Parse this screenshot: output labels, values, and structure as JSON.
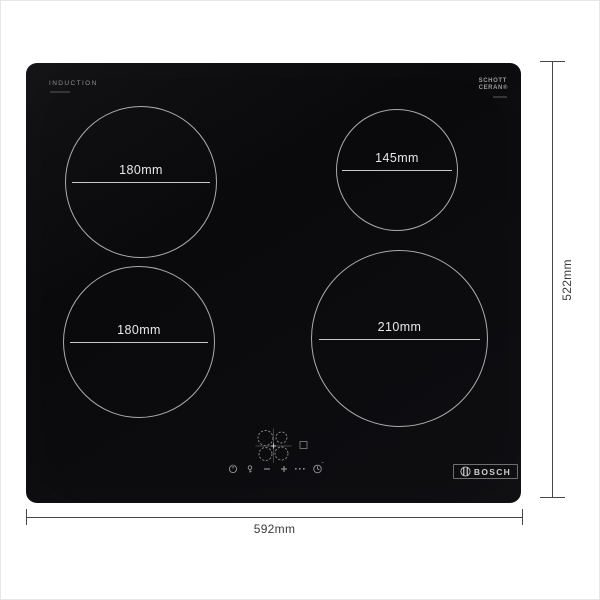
{
  "product": {
    "surface_label": "INDUCTION",
    "glass_brand": {
      "line1": "SCHOTT",
      "line2": "CERAN®"
    },
    "logo_text": "BOSCH"
  },
  "zones": [
    {
      "position": "rear-left",
      "label": "180mm"
    },
    {
      "position": "rear-right",
      "label": "145mm"
    },
    {
      "position": "front-left",
      "label": "180mm"
    },
    {
      "position": "front-right",
      "label": "210mm"
    }
  ],
  "dimensions": {
    "width": "592mm",
    "depth": "522mm"
  },
  "controls": {
    "items": [
      "zone-selector",
      "boost-indicator",
      "power",
      "key-lock",
      "minus",
      "plus",
      "level-marks",
      "timer"
    ]
  },
  "colors": {
    "glass": "#0b0b0d",
    "ring": "#e1e1e1",
    "dimension_line": "#474747",
    "dimension_text": "#3a3a3a"
  }
}
